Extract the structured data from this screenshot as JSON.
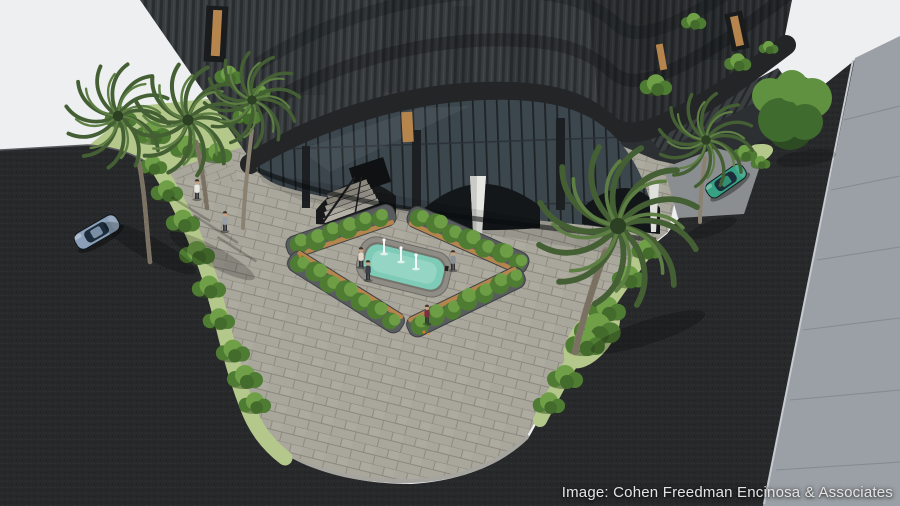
{
  "meta": {
    "type": "architectural_rendering",
    "subject": "Aerial rendering of a dark slatted corner building with a palm-lined entry plaza, fountain and planter beds at a street corner"
  },
  "caption": {
    "text": "Image: Cohen Freedman Encinosa & Associates"
  },
  "palette": {
    "sky": "#edeff0",
    "asphalt": "#27282a",
    "sidewalk": "#9aa0a5",
    "paver": "#a9a69c",
    "paver_joint": "#8b887e",
    "curb": "#a6a49e",
    "grass": "#b4c88b",
    "hedge": "#4f7c33",
    "hedge_light": "#6fa047",
    "palm": "#45603­4",
    "palm_dark": "#445f33",
    "palm_light": "#5e7f44",
    "trunk": "#8b8171",
    "tree": "#3f6b2e",
    "tree_light": "#5f9140",
    "facade": "#383c3f",
    "slat_dark": "#2a2d2f",
    "slat_light": "#4b5054",
    "band": "#232527",
    "glass": "#3c464d",
    "mullion": "#1e2326",
    "wood": "#b5854d",
    "water": "#7ecbb7",
    "water_light": "#a5dccd",
    "concrete_white": "#e6e6e3",
    "car_left": "#8ba0b8",
    "car_right": "#36a283",
    "caption_color": "#e4e4e4"
  },
  "scene": {
    "elements": [
      "corner building",
      "fountain pool with three jets",
      "four planter beds with benches",
      "palm trees",
      "street tree",
      "hedges",
      "paver plaza",
      "asphalt streets",
      "right sidewalk",
      "parked blue car",
      "parked green car",
      "pedestrians",
      "entry stairs",
      "arched storefront"
    ]
  }
}
